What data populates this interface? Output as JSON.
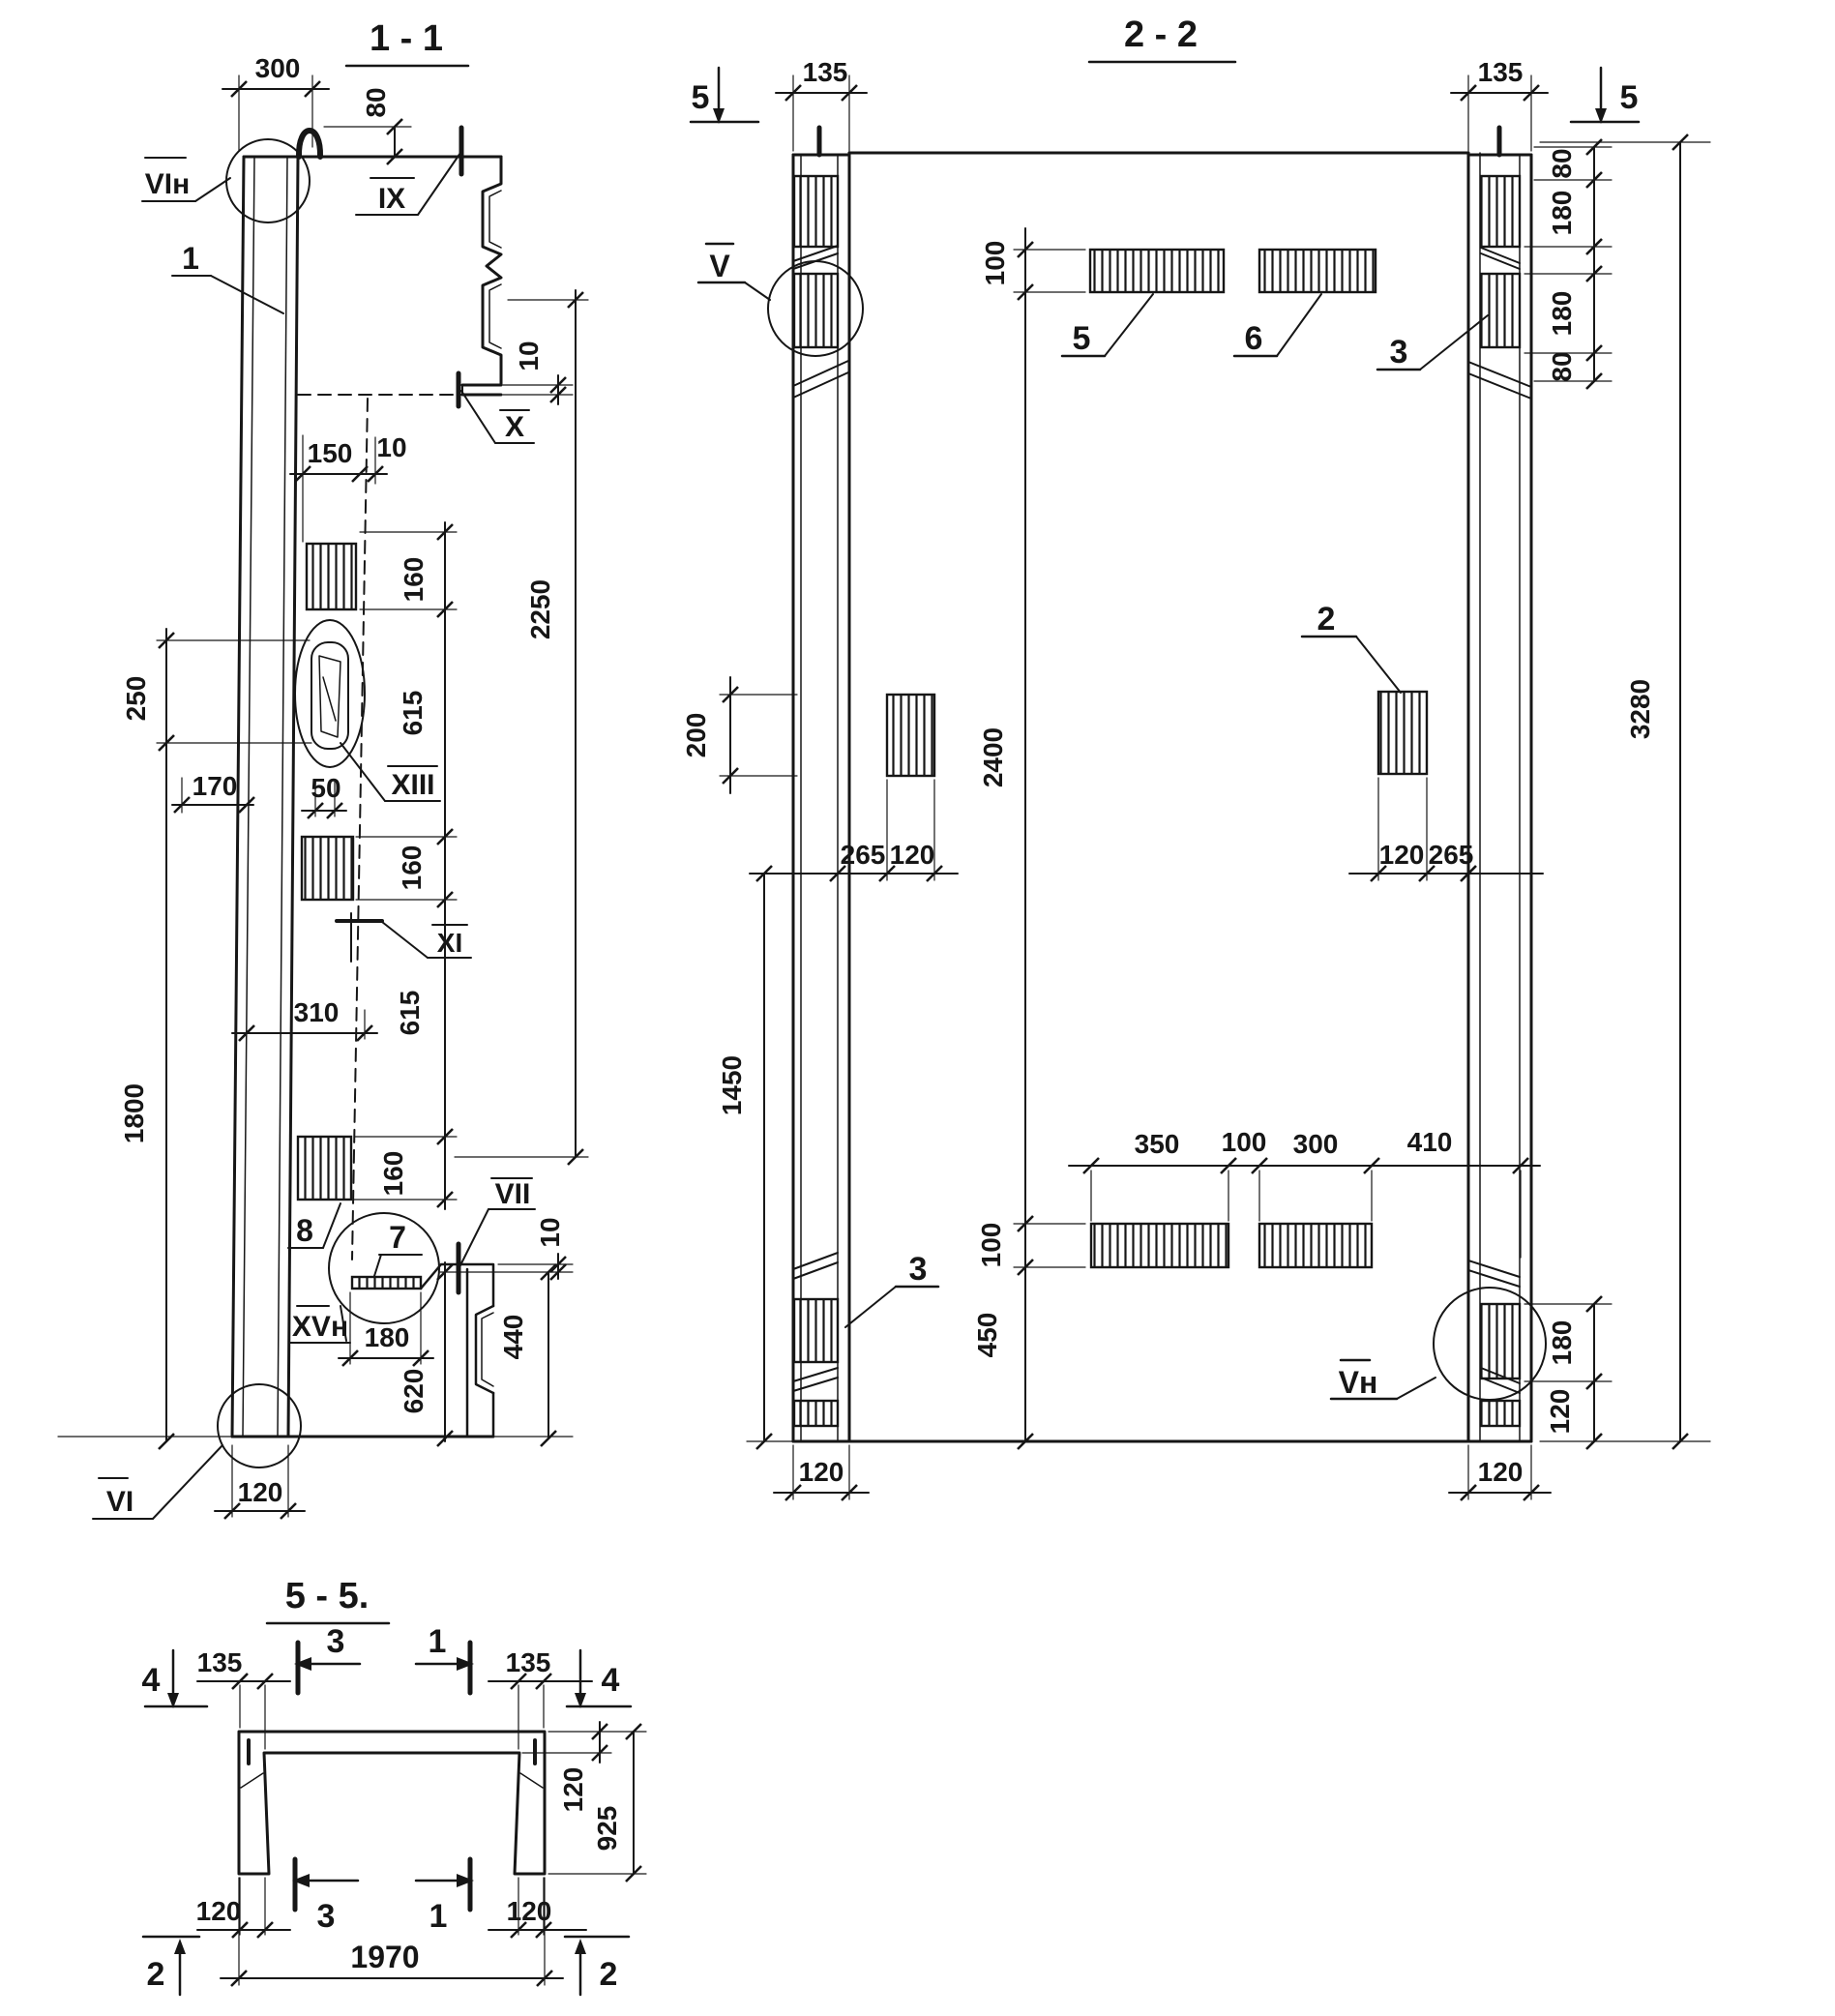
{
  "colors": {
    "ink": "#161616",
    "paper": "#ffffff"
  },
  "sections": {
    "s11": {
      "title": "1 - 1",
      "dims": {
        "d300": "300",
        "d80": "80",
        "d10": "10",
        "d150": "150",
        "d160": "160",
        "d615": "615",
        "d250": "250",
        "d170": "170",
        "d50": "50",
        "d2250": "2250",
        "d310": "310",
        "d1800": "1800",
        "d180": "180",
        "d620": "620",
        "d440": "440",
        "d120": "120"
      },
      "marks": {
        "vin": "VIн",
        "n1": "1",
        "ix": "IX",
        "x": "X",
        "xiii": "XIII",
        "xi": "XI",
        "n8": "8",
        "n7": "7",
        "vii": "VII",
        "xvn": "XVн",
        "vi": "VI"
      }
    },
    "s22": {
      "title": "2 - 2",
      "dims": {
        "d135": "135",
        "d100": "100",
        "d80": "80",
        "d180": "180",
        "d3280": "3280",
        "d200": "200",
        "d2400": "2400",
        "d265": "265",
        "d120": "120",
        "d1450": "1450",
        "d350": "350",
        "d300": "300",
        "d410": "410",
        "d450": "450"
      },
      "marks": {
        "cut5": "5",
        "v": "V",
        "vn": "Vн",
        "n5": "5",
        "n6": "6",
        "n3": "3",
        "n2": "2"
      }
    },
    "s55": {
      "title": "5 - 5.",
      "dims": {
        "d135": "135",
        "d120": "120",
        "d925": "925",
        "d1970": "1970"
      },
      "marks": {
        "c4": "4",
        "c3": "3",
        "c1": "1",
        "c2": "2"
      }
    }
  }
}
